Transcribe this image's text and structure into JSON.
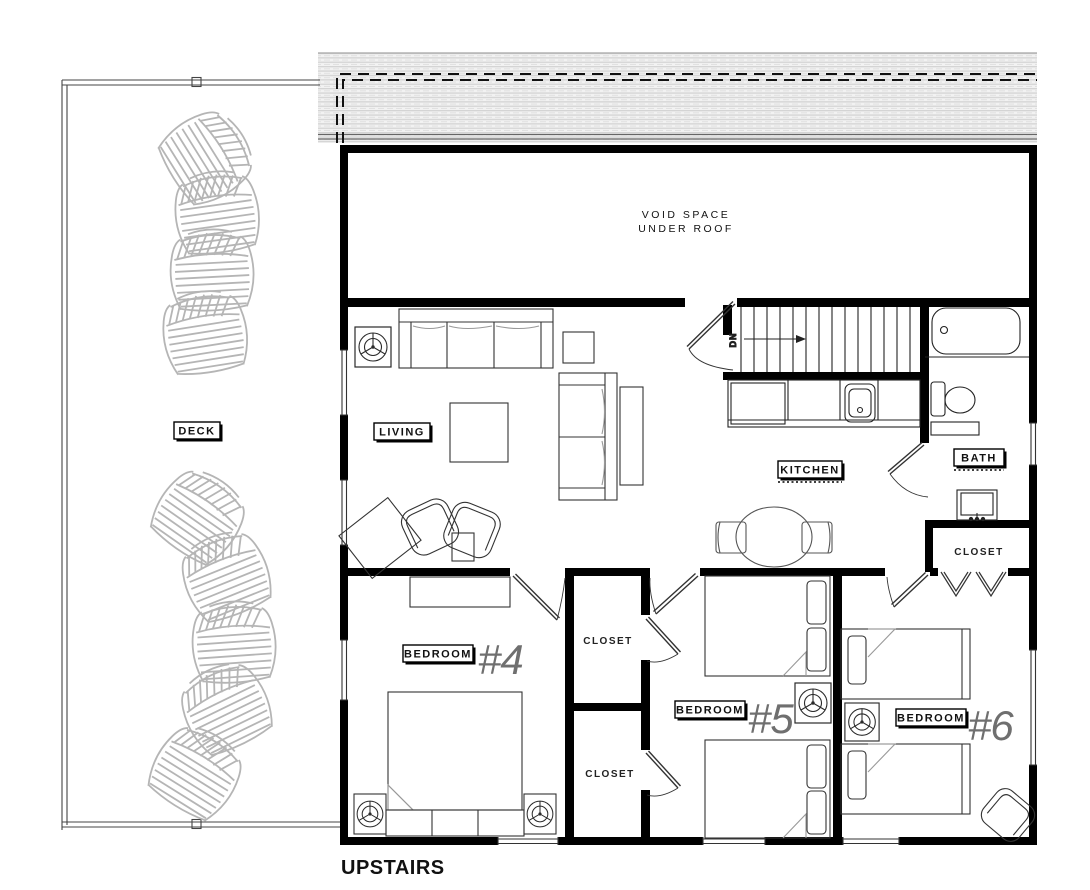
{
  "drawing": {
    "floor_label": "UPSTAIRS",
    "void_space": {
      "line1": "VOID SPACE",
      "line2": "UNDER ROOF"
    },
    "stairs": {
      "direction": "DN"
    },
    "rooms": {
      "deck": "DECK",
      "living": "LIVING",
      "kitchen": "KITCHEN",
      "bath": "BATH",
      "closet_hall_top": "CLOSET",
      "closet_hall_bottom": "CLOSET",
      "closet_bath": "CLOSET",
      "bedroom4": {
        "label": "BEDROOM",
        "number": "#4"
      },
      "bedroom5": {
        "label": "BEDROOM",
        "number": "#5"
      },
      "bedroom6": {
        "label": "BEDROOM",
        "number": "#6"
      }
    },
    "colors": {
      "wall": "#000000",
      "floor_label_teal": "#2a8ba0",
      "roof_hatch_gray": "#d6d6d6",
      "deck_furniture_gray": "#b5b5b5",
      "bedroom_number_gray": "#6f6f6f"
    }
  }
}
